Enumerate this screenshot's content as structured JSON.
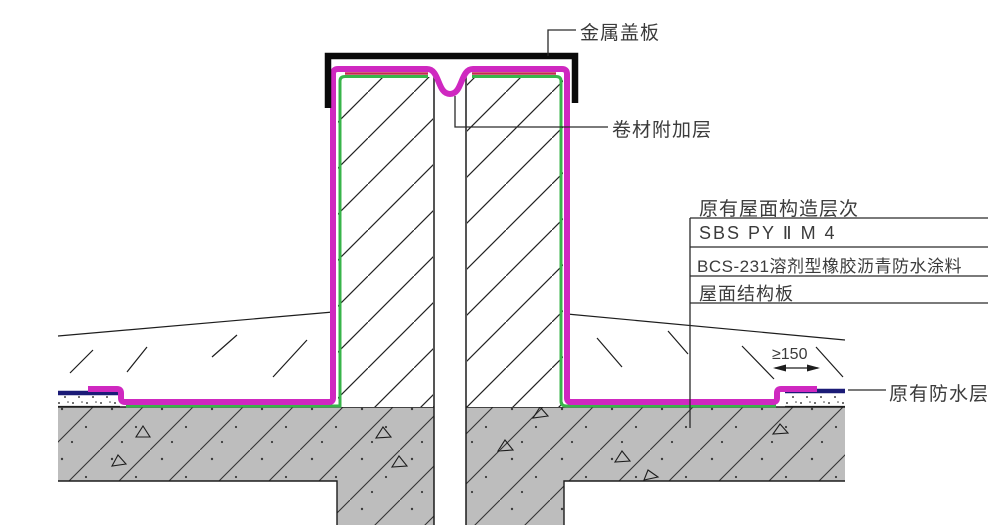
{
  "labels": {
    "metal_cover_plate": "金属盖板",
    "membrane_additional_layer": "卷材附加层",
    "existing_roof_title": "原有屋面构造层次",
    "existing_roof_layers": [
      "SBS PY Ⅱ M 4",
      "BCS-231溶剂型橡胶沥青防水涂料",
      "屋面结构板"
    ],
    "overlap_dimension": "≥150",
    "existing_waterproof_layer": "原有防水层"
  },
  "colors": {
    "new_membrane_magenta": "#cf28c0",
    "membrane_edge_red": "#c42a50",
    "coating_green": "#38b44a",
    "existing_waterproof_blue": "#1b1b77",
    "concrete_gray": "#bdbdbd",
    "line_black": "#1d1d1d"
  }
}
